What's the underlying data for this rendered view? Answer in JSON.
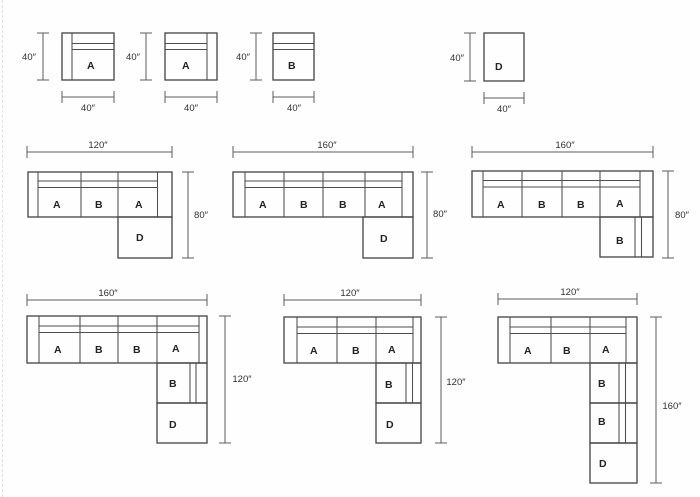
{
  "title": "Sectional sofa module and configuration dimension diagram",
  "colors": {
    "background": "#fefefe",
    "line": "#4a4a4a",
    "dim_line": "#5c5c5c",
    "label_text": "#242424",
    "dim_text": "#303030"
  },
  "units": [
    {
      "name": "unit-armchair-A-left-arm",
      "label": "A",
      "box": [
        62,
        33,
        52,
        47
      ],
      "lines": [
        [
          72,
          33,
          72,
          80
        ],
        [
          72,
          43.5,
          114,
          43.5
        ],
        [
          72,
          49.5,
          114,
          49.5
        ]
      ],
      "label_pos": [
        91,
        65
      ],
      "dims": [
        {
          "dir": "v",
          "x": 43,
          "y1": 33,
          "y2": 80,
          "label": "40″",
          "lx": 29,
          "ly": 60
        },
        {
          "dir": "h",
          "y": 97,
          "x1": 62,
          "x2": 114,
          "label": "40″",
          "lx": 88,
          "ly": 111
        }
      ]
    },
    {
      "name": "unit-armchair-A-right-arm",
      "label": "A",
      "box": [
        165,
        33,
        52,
        47
      ],
      "lines": [
        [
          207,
          33,
          207,
          80
        ],
        [
          165,
          43.5,
          207,
          43.5
        ],
        [
          165,
          49.5,
          207,
          49.5
        ]
      ],
      "label_pos": [
        186,
        65
      ],
      "dims": [
        {
          "dir": "v",
          "x": 146,
          "y1": 33,
          "y2": 80,
          "label": "40″",
          "lx": 133,
          "ly": 60
        },
        {
          "dir": "h",
          "y": 97,
          "x1": 165,
          "x2": 217,
          "label": "40″",
          "lx": 191,
          "ly": 111
        }
      ]
    },
    {
      "name": "unit-armless-B",
      "label": "B",
      "box": [
        273,
        33,
        41,
        47
      ],
      "lines": [
        [
          273,
          43.5,
          314,
          43.5
        ],
        [
          273,
          49.5,
          314,
          49.5
        ]
      ],
      "label_pos": [
        292,
        65
      ],
      "dims": [
        {
          "dir": "v",
          "x": 256,
          "y1": 33,
          "y2": 80,
          "label": "40″",
          "lx": 243,
          "ly": 60
        },
        {
          "dir": "h",
          "y": 97,
          "x1": 273,
          "x2": 314,
          "label": "40″",
          "lx": 294,
          "ly": 111
        }
      ]
    },
    {
      "name": "unit-ottoman-D",
      "label": "D",
      "box": [
        484,
        33,
        40,
        48
      ],
      "lines": [],
      "label_pos": [
        499,
        66
      ],
      "dims": [
        {
          "dir": "v",
          "x": 470,
          "y1": 33,
          "y2": 81,
          "label": "40″",
          "lx": 457,
          "ly": 61
        },
        {
          "dir": "h",
          "y": 98,
          "x1": 484,
          "x2": 524,
          "label": "40″",
          "lx": 504,
          "ly": 112
        }
      ]
    }
  ],
  "configs": [
    {
      "name": "config-120in-x-80in-ABA-D",
      "width_label": "120″",
      "height_label": "80″",
      "sofa_box": [
        28,
        172,
        144,
        45
      ],
      "lines": [
        [
          38,
          172,
          38,
          217
        ],
        [
          38,
          181,
          157.5,
          181
        ],
        [
          38,
          187.5,
          157.5,
          187.5
        ],
        [
          81,
          172,
          81,
          217
        ],
        [
          118,
          172,
          118,
          217
        ],
        [
          157.5,
          172,
          157.5,
          217
        ]
      ],
      "seats": [
        {
          "t": "A",
          "x": 57,
          "y": 204
        },
        {
          "t": "B",
          "x": 99,
          "y": 204
        },
        {
          "t": "A",
          "x": 139,
          "y": 204
        }
      ],
      "stack": [
        {
          "box": [
            118,
            217,
            54,
            41
          ],
          "t": "D",
          "lx": 140,
          "ly": 237
        }
      ],
      "extra_lines": [],
      "dims": [
        {
          "dir": "h",
          "y": 152,
          "x1": 27,
          "x2": 172,
          "label": "120″",
          "lx": 98,
          "ly": 148
        },
        {
          "dir": "v",
          "x": 188,
          "y1": 172,
          "y2": 258,
          "label": "80″",
          "lx": 201,
          "ly": 218
        }
      ]
    },
    {
      "name": "config-160in-x-80in-ABBA-D",
      "width_label": "160″",
      "height_label": "80″",
      "sofa_box": [
        233,
        172,
        180,
        45
      ],
      "lines": [
        [
          245,
          172,
          245,
          217
        ],
        [
          245,
          181,
          402,
          181
        ],
        [
          245,
          187.5,
          402,
          187.5
        ],
        [
          284,
          172,
          284,
          217
        ],
        [
          323,
          172,
          323,
          217
        ],
        [
          365,
          172,
          365,
          217
        ],
        [
          402,
          172,
          402,
          217
        ]
      ],
      "seats": [
        {
          "t": "A",
          "x": 263,
          "y": 204
        },
        {
          "t": "B",
          "x": 304,
          "y": 204
        },
        {
          "t": "B",
          "x": 343,
          "y": 204
        },
        {
          "t": "A",
          "x": 382,
          "y": 204
        }
      ],
      "stack": [
        {
          "box": [
            363,
            217,
            50,
            41
          ],
          "t": "D",
          "lx": 384,
          "ly": 238
        }
      ],
      "extra_lines": [],
      "dims": [
        {
          "dir": "h",
          "y": 152,
          "x1": 233,
          "x2": 413,
          "label": "160″",
          "lx": 327,
          "ly": 148
        },
        {
          "dir": "v",
          "x": 427,
          "y1": 172,
          "y2": 258,
          "label": "80″",
          "lx": 440,
          "ly": 217
        }
      ]
    },
    {
      "name": "config-160in-x-80in-ABBA-B-return",
      "width_label": "160″",
      "height_label": "80″",
      "sofa_box": [
        472,
        171,
        181,
        46
      ],
      "lines": [
        [
          483,
          171,
          483,
          217
        ],
        [
          483,
          180.5,
          640,
          180.5
        ],
        [
          483,
          187,
          640,
          187
        ],
        [
          522,
          171,
          522,
          217
        ],
        [
          562,
          171,
          562,
          217
        ],
        [
          600,
          171,
          600,
          217
        ],
        [
          640,
          171,
          640,
          217
        ]
      ],
      "seats": [
        {
          "t": "A",
          "x": 501,
          "y": 204
        },
        {
          "t": "B",
          "x": 542,
          "y": 204
        },
        {
          "t": "B",
          "x": 581,
          "y": 204
        },
        {
          "t": "A",
          "x": 620,
          "y": 203
        }
      ],
      "stack": [
        {
          "box": [
            600,
            217,
            53,
            40
          ],
          "t": "B",
          "lx": 620,
          "ly": 240
        }
      ],
      "extra_lines": [
        [
          635,
          217,
          635,
          257
        ],
        [
          641.5,
          217,
          641.5,
          257
        ]
      ],
      "dims": [
        {
          "dir": "h",
          "y": 152,
          "x1": 472,
          "x2": 653,
          "label": "160″",
          "lx": 565,
          "ly": 148
        },
        {
          "dir": "v",
          "x": 668,
          "y1": 171,
          "y2": 258,
          "label": "80″",
          "lx": 682,
          "ly": 218
        }
      ]
    },
    {
      "name": "config-160in-x-120in-ABBA-B-D",
      "width_label": "160″",
      "height_label": "120″",
      "sofa_box": [
        27,
        316,
        180,
        47
      ],
      "lines": [
        [
          39,
          316,
          39,
          363
        ],
        [
          39,
          326,
          199,
          326
        ],
        [
          39,
          332.5,
          199,
          332.5
        ],
        [
          80,
          316,
          80,
          363
        ],
        [
          118,
          316,
          118,
          363
        ],
        [
          157,
          316,
          157,
          363
        ],
        [
          199,
          316,
          199,
          363
        ]
      ],
      "seats": [
        {
          "t": "A",
          "x": 58,
          "y": 349
        },
        {
          "t": "B",
          "x": 99,
          "y": 349
        },
        {
          "t": "B",
          "x": 137,
          "y": 349
        },
        {
          "t": "A",
          "x": 176,
          "y": 348
        }
      ],
      "stack": [
        {
          "box": [
            157,
            363,
            50,
            40
          ],
          "t": "B",
          "lx": 173,
          "ly": 383
        },
        {
          "box": [
            157,
            403,
            50,
            40
          ],
          "t": "D",
          "lx": 173,
          "ly": 424
        }
      ],
      "extra_lines": [
        [
          190,
          363,
          190,
          403
        ],
        [
          196,
          363,
          196,
          403
        ]
      ],
      "dims": [
        {
          "dir": "h",
          "y": 300,
          "x1": 27,
          "x2": 207,
          "label": "160″",
          "lx": 108,
          "ly": 296
        },
        {
          "dir": "v",
          "x": 225,
          "y1": 316,
          "y2": 443,
          "label": "120″",
          "lx": 242,
          "ly": 382
        }
      ]
    },
    {
      "name": "config-120in-x-120in-ABA-B-D",
      "width_label": "120″",
      "height_label": "120″",
      "sofa_box": [
        284,
        317,
        137,
        46
      ],
      "lines": [
        [
          297,
          317,
          297,
          363
        ],
        [
          297,
          327,
          413,
          327
        ],
        [
          297,
          333.5,
          413,
          333.5
        ],
        [
          337,
          317,
          337,
          363
        ],
        [
          376,
          317,
          376,
          363
        ],
        [
          413,
          317,
          413,
          363
        ]
      ],
      "seats": [
        {
          "t": "A",
          "x": 314,
          "y": 350
        },
        {
          "t": "B",
          "x": 356,
          "y": 350
        },
        {
          "t": "A",
          "x": 392,
          "y": 349
        }
      ],
      "stack": [
        {
          "box": [
            376,
            363,
            45,
            40
          ],
          "t": "B",
          "lx": 389,
          "ly": 384
        },
        {
          "box": [
            376,
            403,
            45,
            40
          ],
          "t": "D",
          "lx": 390,
          "ly": 424
        }
      ],
      "extra_lines": [
        [
          406,
          363,
          406,
          403
        ],
        [
          412.5,
          363,
          412.5,
          403
        ]
      ],
      "dims": [
        {
          "dir": "h",
          "y": 300,
          "x1": 284,
          "x2": 421,
          "label": "120″",
          "lx": 350,
          "ly": 296
        },
        {
          "dir": "v",
          "x": 441,
          "y1": 317,
          "y2": 443,
          "label": "120″",
          "lx": 456,
          "ly": 385
        }
      ]
    },
    {
      "name": "config-120in-x-160in-ABA-B-B-D",
      "width_label": "120″",
      "height_label": "160″",
      "sofa_box": [
        498,
        317,
        139,
        46
      ],
      "lines": [
        [
          510,
          317,
          510,
          363
        ],
        [
          510,
          327,
          626,
          327
        ],
        [
          510,
          333.5,
          626,
          333.5
        ],
        [
          551,
          317,
          551,
          363
        ],
        [
          590,
          317,
          590,
          363
        ],
        [
          626,
          317,
          626,
          363
        ]
      ],
      "seats": [
        {
          "t": "A",
          "x": 528,
          "y": 350
        },
        {
          "t": "B",
          "x": 567,
          "y": 350
        },
        {
          "t": "A",
          "x": 606,
          "y": 349
        }
      ],
      "stack": [
        {
          "box": [
            590,
            363,
            47,
            40
          ],
          "t": "B",
          "lx": 602,
          "ly": 383
        },
        {
          "box": [
            590,
            403,
            47,
            40
          ],
          "t": "B",
          "lx": 602,
          "ly": 421
        },
        {
          "box": [
            590,
            443,
            47,
            40
          ],
          "t": "D",
          "lx": 603,
          "ly": 463
        }
      ],
      "extra_lines": [
        [
          619,
          363,
          619,
          443
        ],
        [
          625.5,
          363,
          625.5,
          443
        ]
      ],
      "dims": [
        {
          "dir": "h",
          "y": 299,
          "x1": 498,
          "x2": 637,
          "label": "120″",
          "lx": 570,
          "ly": 295
        },
        {
          "dir": "v",
          "x": 656,
          "y1": 317,
          "y2": 483,
          "label": "160″",
          "lx": 672,
          "ly": 409
        }
      ]
    }
  ]
}
